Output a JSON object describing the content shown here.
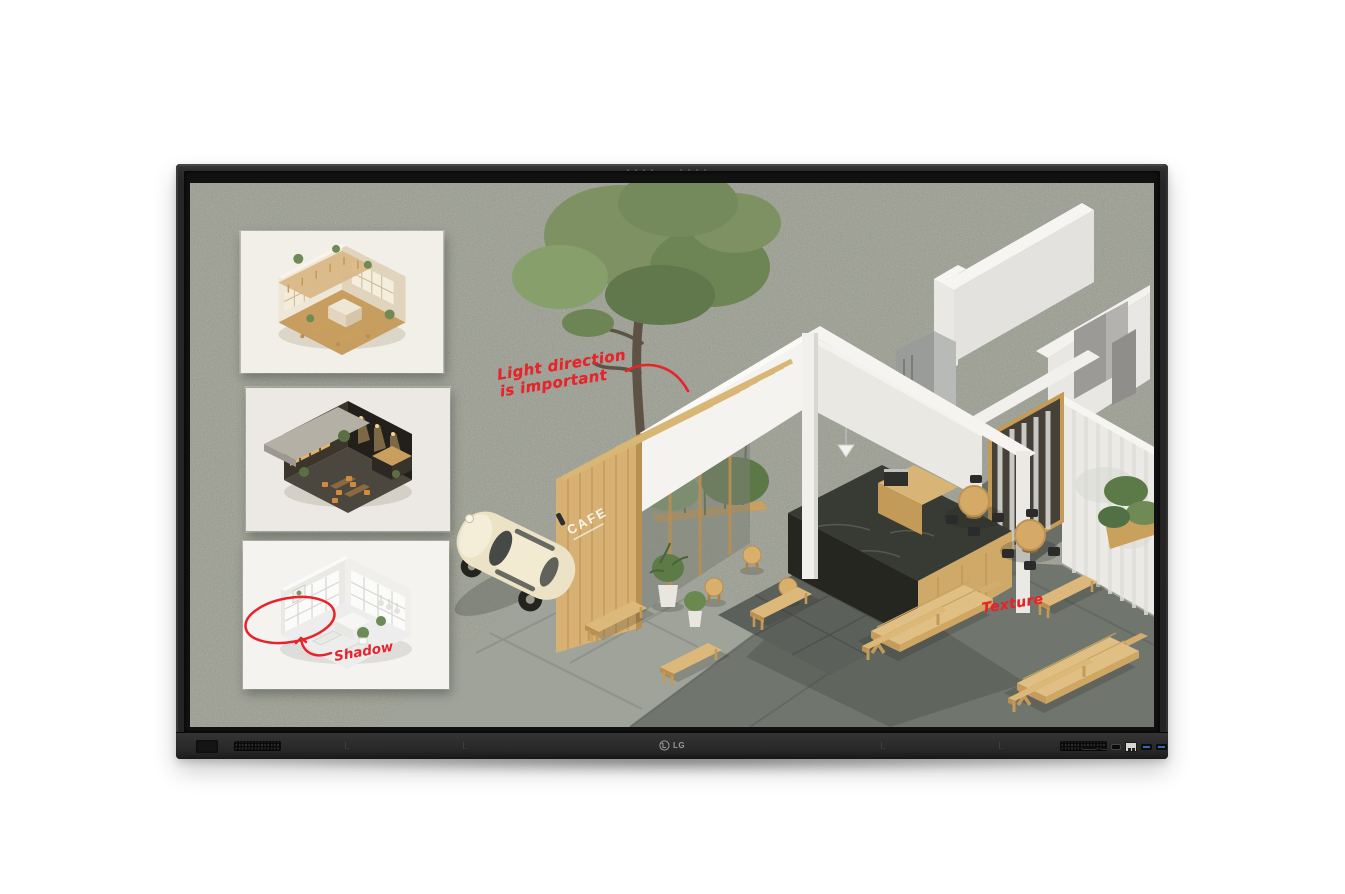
{
  "device": {
    "brand_logo": "LG"
  },
  "whiteboard": {
    "annotations": {
      "light_direction": {
        "line1": "Light direction",
        "line2": "is important"
      },
      "shadow": {
        "label": "Shadow"
      },
      "texture": {
        "label": "Texture"
      }
    },
    "main_scene": {
      "name": "isometric-cafe-exterior-render",
      "cafe_sign": "CAFE"
    },
    "thumbnails": [
      {
        "name": "warm-cafe-interior-thumbnail"
      },
      {
        "name": "dark-cafe-interior-thumbnail"
      },
      {
        "name": "bright-cafe-interior-thumbnail"
      }
    ],
    "colors": {
      "annotation_red": "#e7242b",
      "board_felt": "#a6a99c",
      "bezel": "#262626",
      "wood": "#d2ab6c",
      "wall_white": "#eceae6",
      "pavement_dark": "#70756e"
    }
  }
}
